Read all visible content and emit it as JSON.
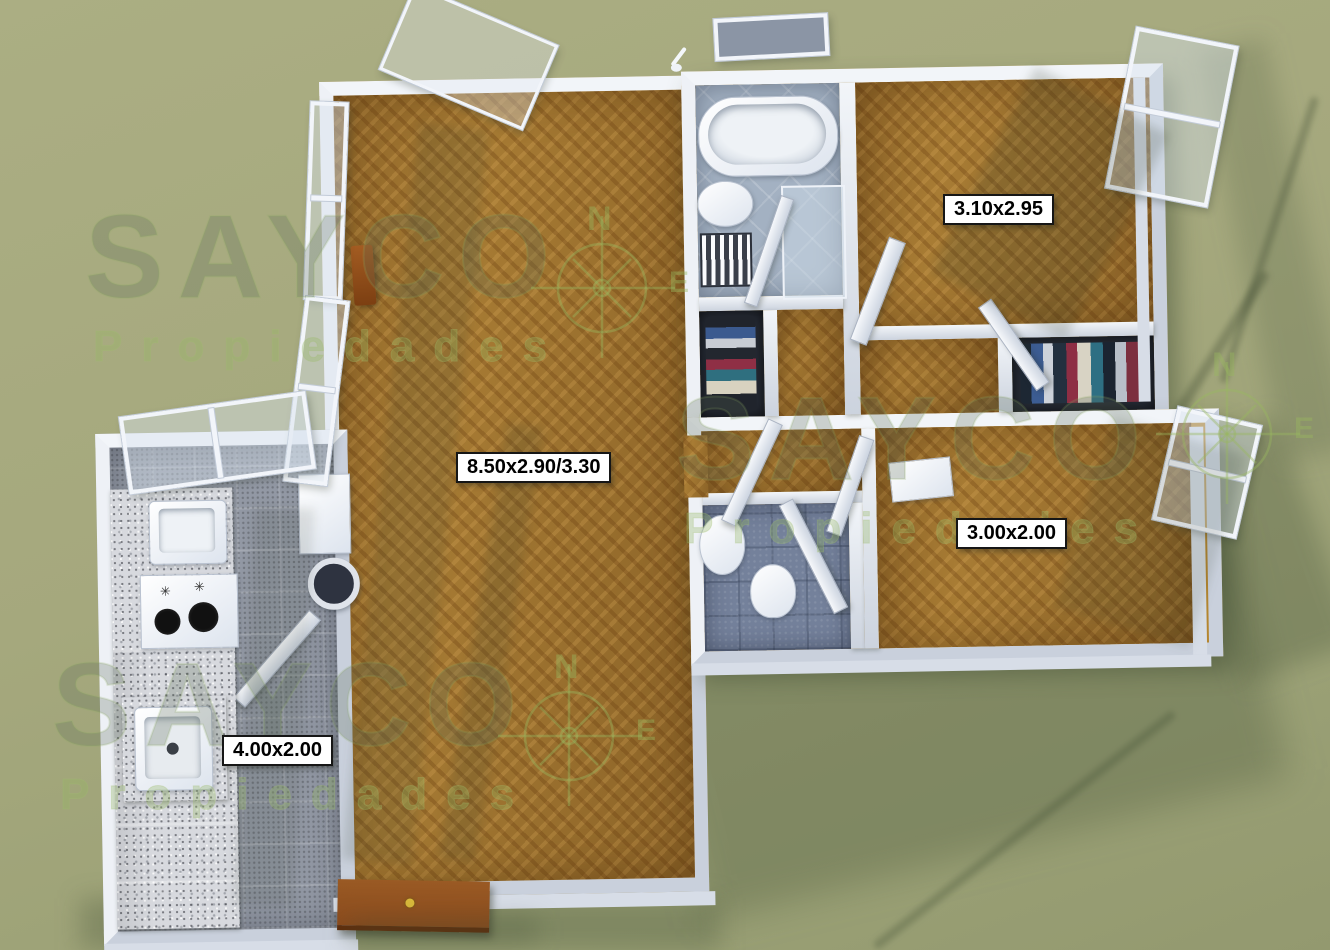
{
  "watermark": {
    "brand": "SAYCO",
    "subtitle": "Propiedades",
    "compass_north": "N",
    "compass_east": "E"
  },
  "room_labels": {
    "bedroom_top_right": "3.10x2.95",
    "living_room": "8.50x2.90/3.30",
    "bedroom_right": "3.00x2.00",
    "kitchen": "4.00x2.00"
  },
  "colors": {
    "background": "#a5a87d",
    "wall": "#e9edf4",
    "parquet": "#a87c34",
    "kitchen_tile": "#9298a4",
    "bath_tile": "#a3b1c2",
    "bath2_tile": "#74819b",
    "granite": "#d7d9de",
    "entrance_door": "#8a4a1c",
    "watermark_green": "#8faf5a",
    "label_background": "#ffffff",
    "label_text": "#000000"
  }
}
